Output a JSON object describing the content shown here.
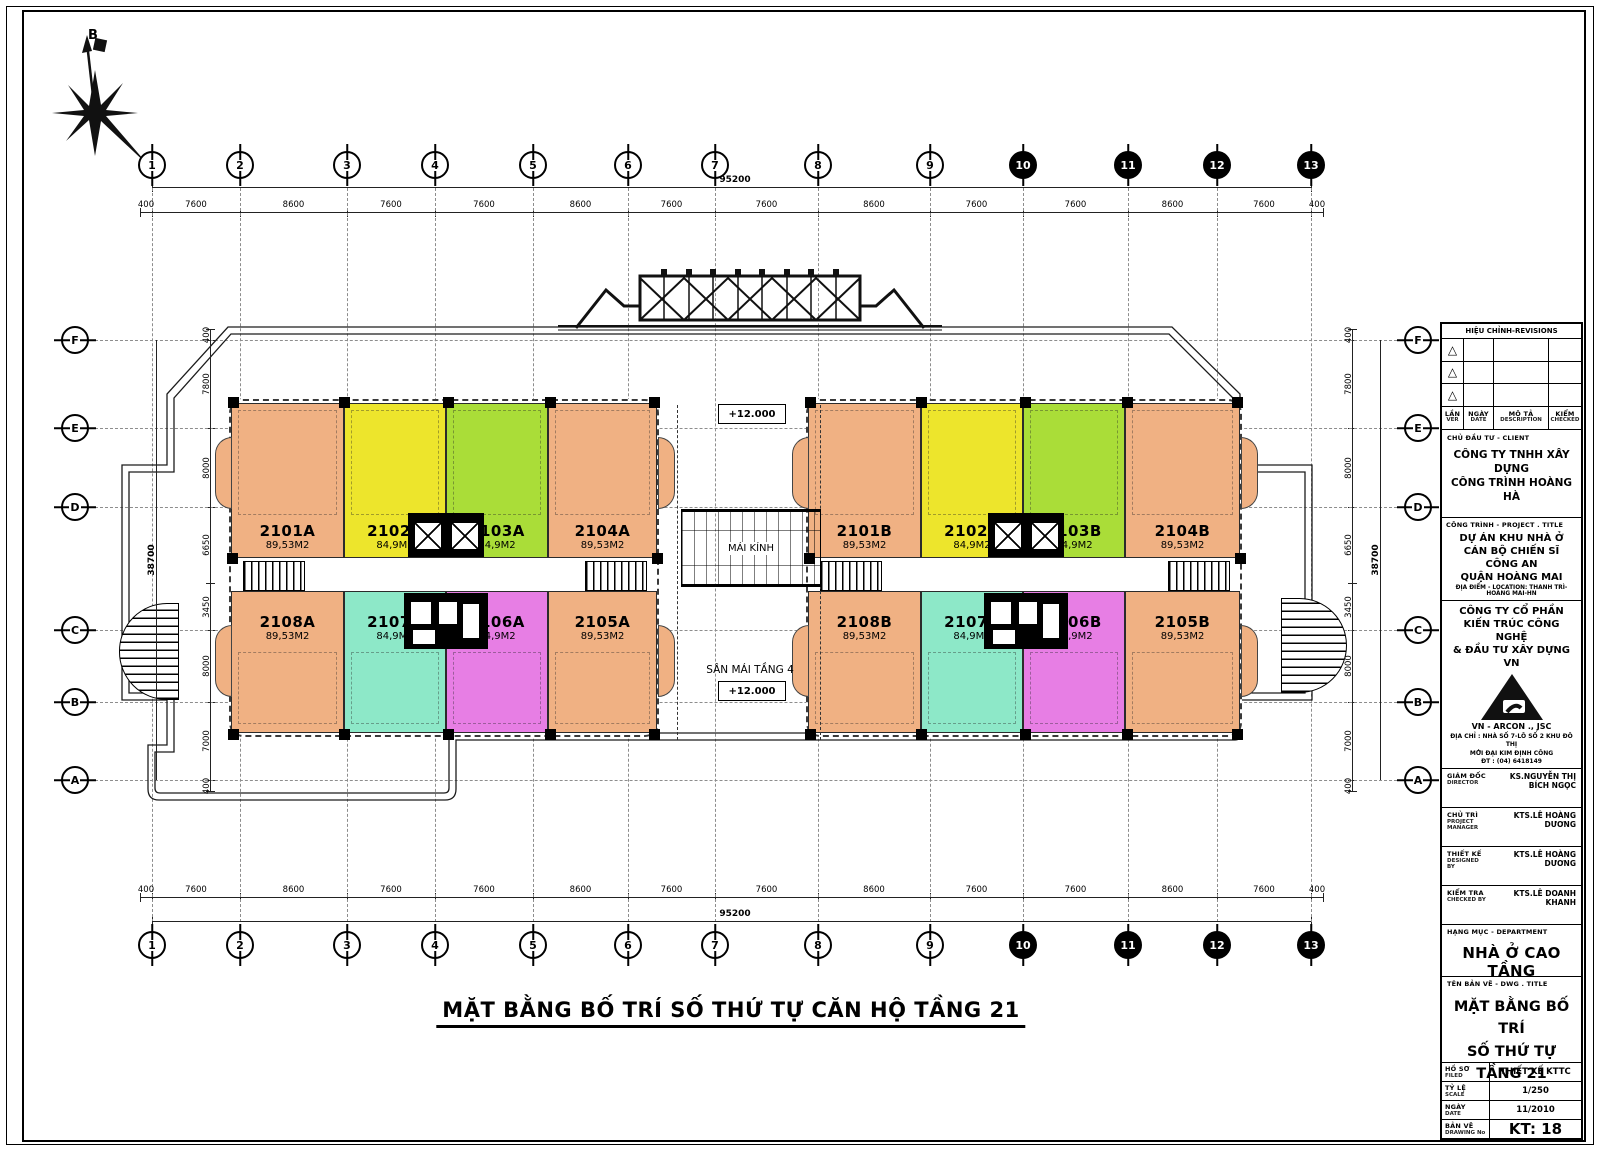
{
  "north_label": "B",
  "sheet": {
    "drawing_title": "MẶT BẰNG BỐ TRÍ SỐ THỨ TỰ CĂN HỘ TẦNG 21"
  },
  "plan": {
    "center": {
      "glass_roof": "MÁI KÍNH",
      "level_upper": "+12.000",
      "terrace": "SÂN MÁI TẦNG 4",
      "level_lower": "+12.000"
    },
    "blocks": [
      {
        "name": "A",
        "top": [
          {
            "id": "2101A",
            "area": "89,53M2",
            "color": "tan"
          },
          {
            "id": "2102A",
            "area": "84,9M2",
            "color": "yellow"
          },
          {
            "id": "2103A",
            "area": "84,9M2",
            "color": "green"
          },
          {
            "id": "2104A",
            "area": "89,53M2",
            "color": "tan"
          }
        ],
        "bottom": [
          {
            "id": "2108A",
            "area": "89,53M2",
            "color": "tan"
          },
          {
            "id": "2107A",
            "area": "84,9M2",
            "color": "teal"
          },
          {
            "id": "2106A",
            "area": "84,9M2",
            "color": "magenta"
          },
          {
            "id": "2105A",
            "area": "89,53M2",
            "color": "tan"
          }
        ]
      },
      {
        "name": "B",
        "top": [
          {
            "id": "2101B",
            "area": "89,53M2",
            "color": "tan"
          },
          {
            "id": "2102B",
            "area": "84,9M2",
            "color": "yellow"
          },
          {
            "id": "2103B",
            "area": "84,9M2",
            "color": "green"
          },
          {
            "id": "2104B",
            "area": "89,53M2",
            "color": "tan"
          }
        ],
        "bottom": [
          {
            "id": "2108B",
            "area": "89,53M2",
            "color": "tan"
          },
          {
            "id": "2107B",
            "area": "84,9M2",
            "color": "teal"
          },
          {
            "id": "2106B",
            "area": "84,9M2",
            "color": "magenta"
          },
          {
            "id": "2105B",
            "area": "89,53M2",
            "color": "tan"
          }
        ]
      }
    ]
  },
  "grid": {
    "columns": [
      "1",
      "2",
      "3",
      "4",
      "5",
      "6",
      "7",
      "8",
      "9",
      "10",
      "11",
      "12",
      "13"
    ],
    "rows": [
      "F",
      "E",
      "D",
      "C",
      "B",
      "A"
    ]
  },
  "dimensions": {
    "top": [
      "400",
      "7600",
      "8600",
      "7600",
      "7600",
      "8600",
      "7600",
      "7600",
      "8600",
      "7600",
      "7600",
      "8600",
      "7600",
      "400"
    ],
    "bottom": [
      "400",
      "7600",
      "8600",
      "7600",
      "7600",
      "8600",
      "7600",
      "7600",
      "8600",
      "7600",
      "7600",
      "8600",
      "7600",
      "400"
    ],
    "total_width": "95200",
    "left": [
      "400",
      "7800",
      "8000",
      "6650",
      "3450",
      "8000",
      "7000",
      "400"
    ],
    "right": [
      "400",
      "7800",
      "8000",
      "6650",
      "3450",
      "8000",
      "7000",
      "400"
    ],
    "total_height": "38700"
  },
  "colors": {
    "tan": "#F0B183",
    "yellow": "#EDE52C",
    "green": "#AADD38",
    "teal": "#8DE8C8",
    "magenta": "#E77EE4"
  },
  "titleblock": {
    "revisions": {
      "title": "HIỆU CHỈNH-REVISIONS",
      "col1": [
        "LẦN",
        "VER"
      ],
      "col2": [
        "NGÀY",
        "DATE"
      ],
      "col3": [
        "MÔ TẢ",
        "DESCRIPTION"
      ],
      "col4": [
        "KIỂM",
        "CHECKED"
      ]
    },
    "client": {
      "label": "CHỦ ĐẦU TƯ - CLIENT",
      "name": [
        "CÔNG TY TNHH XÂY DỰNG",
        "CÔNG TRÌNH HOÀNG HÀ"
      ]
    },
    "project": {
      "label": "CÔNG TRÌNH - PROJECT . TITLE",
      "name": [
        "DỰ ÁN KHU NHÀ Ở",
        "CÁN BỘ CHIẾN SĨ CÔNG AN",
        "QUẬN HOÀNG MAI"
      ],
      "location": "ĐỊA ĐIỂM - LOCATION: THANH TRÌ-HOÀNG MAI-HN"
    },
    "architect": {
      "name": [
        "CÔNG TY CỔ PHẦN",
        "KIẾN TRÚC CÔNG NGHỆ",
        "& ĐẦU TƯ XÂY DỰNG VN"
      ],
      "short_name": "VN - ARCON ., JSC",
      "address": [
        "ĐỊA CHỈ : NHÀ SỐ 7-LÔ SỐ 2 KHU ĐÔ THỊ",
        "MỚI ĐẠI KIM ĐỊNH CÔNG",
        "ĐT : (04) 6418149"
      ]
    },
    "roles": [
      {
        "label": "GIÁM ĐỐC",
        "sub": "DIRECTOR",
        "value": "KS.NGUYỄN THỊ BÍCH NGỌC"
      },
      {
        "label": "CHỦ TRÌ",
        "sub": "PROJECT MANAGER",
        "value": "KTS.LÊ HOÀNG DƯƠNG"
      },
      {
        "label": "THIẾT KẾ",
        "sub": "DESIGNED BY",
        "value": "KTS.LÊ HOÀNG DƯƠNG"
      },
      {
        "label": "KIỂM TRA",
        "sub": "CHECKED BY",
        "value": "KTS.LÊ DOANH KHANH"
      }
    ],
    "department": {
      "label": "HẠNG MỤC - DEPARTMENT",
      "value": "NHÀ Ở CAO TẦNG"
    },
    "drawing": {
      "label": "TÊN BẢN VẼ - DWG . TITLE",
      "value": [
        "MẶT BẰNG BỐ TRÍ",
        "SỐ THỨ TỰ TẦNG 21"
      ]
    },
    "footer": [
      {
        "label": "HỒ SƠ",
        "sub": "FILED",
        "value": "THIẾT KẾ KTTC"
      },
      {
        "label": "TỶ LỆ",
        "sub": "SCALE",
        "value": "1/250"
      },
      {
        "label": "NGÀY",
        "sub": "DATE",
        "value": "11/2010"
      },
      {
        "label": "BẢN VẼ",
        "sub": "DRAWING No",
        "value": "KT: 18"
      }
    ]
  }
}
